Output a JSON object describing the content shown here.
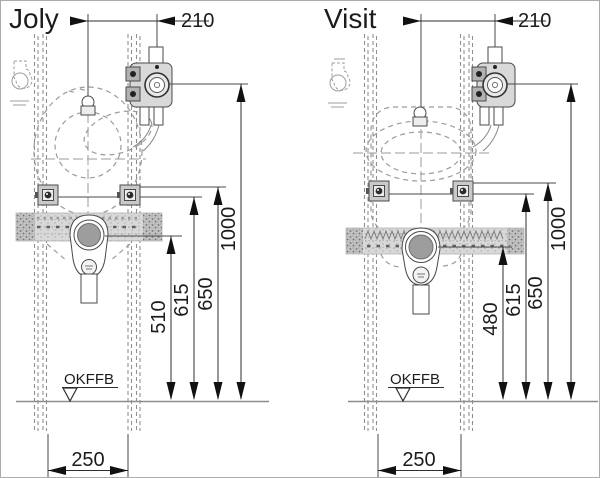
{
  "page": {
    "background": "#ffffff",
    "line_color": "#2e2e2e",
    "drawing_color": "#9b9b9b",
    "fill_light": "#d9d9d9"
  },
  "diagrams": [
    {
      "title": "Joly",
      "floor_label": "OKFFB",
      "dimensions": {
        "faucet_offset": "210",
        "height_main": "1000",
        "height_rail_top": "650",
        "height_brackets": "615",
        "height_drain": "510",
        "rail_spacing": "250"
      }
    },
    {
      "title": "Visit",
      "floor_label": "OKFFB",
      "dimensions": {
        "faucet_offset": "210",
        "height_main": "1000",
        "height_rail_top": "650",
        "height_brackets": "615",
        "height_drain": "480",
        "rail_spacing": "250"
      }
    }
  ]
}
